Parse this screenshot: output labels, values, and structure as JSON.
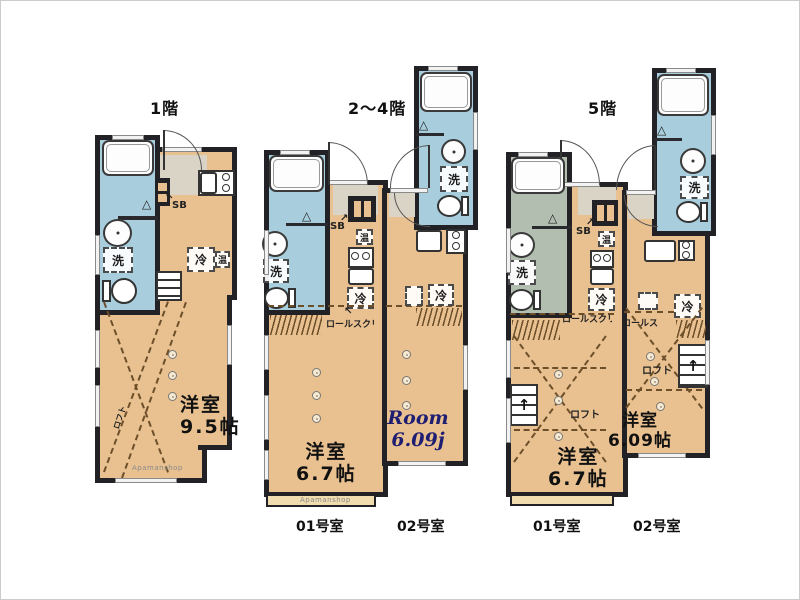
{
  "colors": {
    "wall": "#222226",
    "floor_tan": "#e9c190",
    "bath_blue": "#a8cddc",
    "bath_green": "#b2beb0",
    "entry_gray": "#d9d4c5",
    "room_en_text": "#1d1d72"
  },
  "labels": {
    "washer": "洗",
    "fridge": "冷",
    "heater": "温",
    "shoe_box": "SB",
    "loft": "ロフト",
    "roll_screen": "ロールスクリーン",
    "watermark": "Apamanshop"
  },
  "icons": {
    "triangle": "△",
    "arrow_up_left": "↖",
    "arrow_up_right": "↗",
    "arrow_up": "↑"
  },
  "plans": [
    {
      "title": "1階",
      "room_label": "洋室",
      "room_size": "9.5帖"
    },
    {
      "title": "2〜4階",
      "units": [
        {
          "number": "01号室",
          "room_label": "洋室",
          "room_size": "6.7帖"
        },
        {
          "number": "02号室",
          "room_label": "Room",
          "room_size": "6.09j"
        }
      ]
    },
    {
      "title": "5階",
      "units": [
        {
          "number": "01号室",
          "room_label": "洋室",
          "room_size": "6.7帖"
        },
        {
          "number": "02号室",
          "room_label": "洋室",
          "room_size": "6.09帖"
        }
      ]
    }
  ]
}
